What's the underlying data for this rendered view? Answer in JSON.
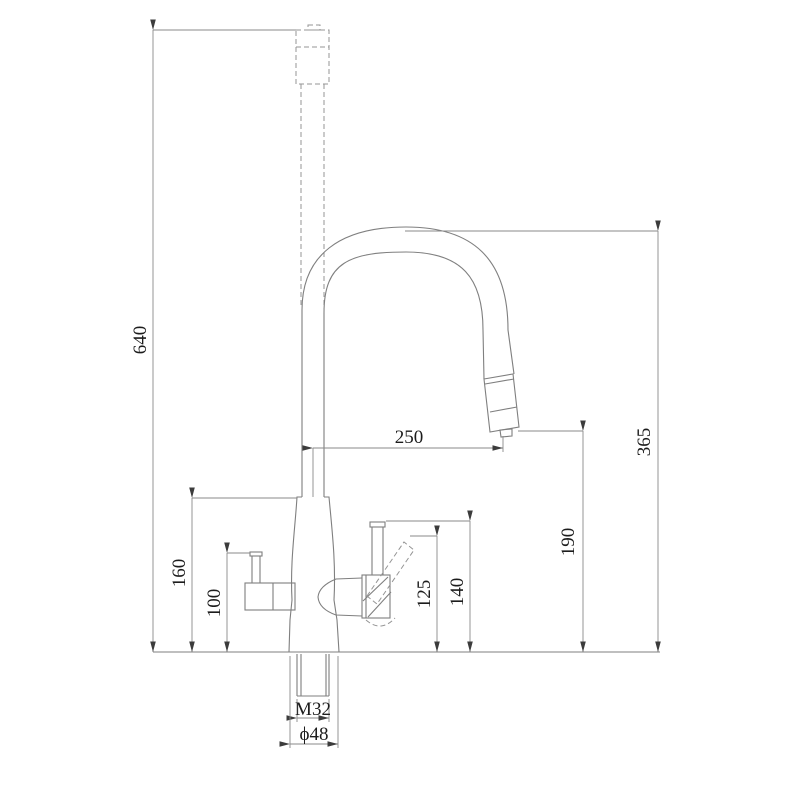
{
  "drawing": {
    "kind": "faucet-dimension-drawing",
    "dims": {
      "overall_height": "640",
      "spout_top_height": "365",
      "spout_reach": "250",
      "outlet_height": "190",
      "body_shoulder_height": "160",
      "filter_handle_height": "100",
      "lever_tilted_height": "125",
      "lever_upright_height": "140",
      "shank_thread": "M32",
      "base_diameter": "ϕ48"
    },
    "colors": {
      "object_line": "#7f7f7f",
      "dimension_line": "#8a8a8a",
      "text": "#1c1c1c",
      "background": "#ffffff"
    }
  }
}
